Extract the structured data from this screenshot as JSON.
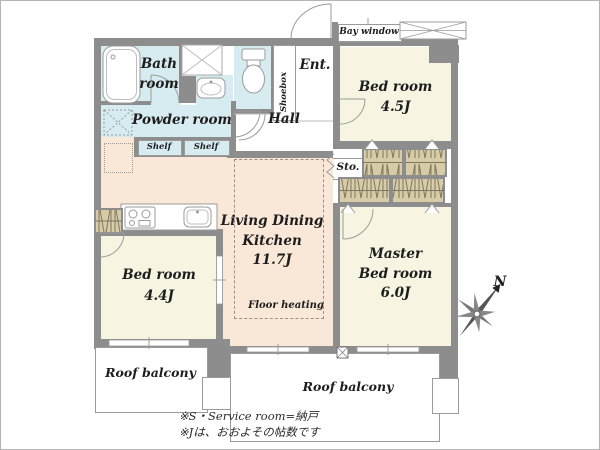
{
  "plan": {
    "rooms": {
      "bath": {
        "line1": "Bath",
        "line2": "room"
      },
      "powder_room": "Powder room",
      "shelf_left": "Shelf",
      "shelf_right": "Shelf",
      "shoebox": "Shoebox",
      "entrance": "Ent.",
      "hall": "Hall",
      "bay_window": "Bay window",
      "bedroom_ne": {
        "name": "Bed room",
        "size": "4.5J"
      },
      "storage": "Sto.",
      "ldk": {
        "line1": "Living Dining",
        "line2": "Kitchen",
        "size": "11.7J",
        "floor_note": "Floor heating"
      },
      "bedroom_sw": {
        "name": "Bed room",
        "size": "4.4J"
      },
      "master_bedroom": {
        "line1": "Master",
        "line2": "Bed room",
        "size": "6.0J"
      },
      "roof_balcony_left": "Roof balcony",
      "roof_balcony_right": "Roof balcony"
    },
    "compass": {
      "north": "N"
    },
    "notes": {
      "line1": "※S・Service room=納戸",
      "line2": "※Jは、おおよその帖数です"
    },
    "colors": {
      "wall": "#8d8d8d",
      "wet_area": "#d7ecf1",
      "ldk": "#f9e7d8",
      "bedroom": "#f7f5e2",
      "closet": "#d8cca6",
      "line": "#9b9b9b"
    }
  }
}
